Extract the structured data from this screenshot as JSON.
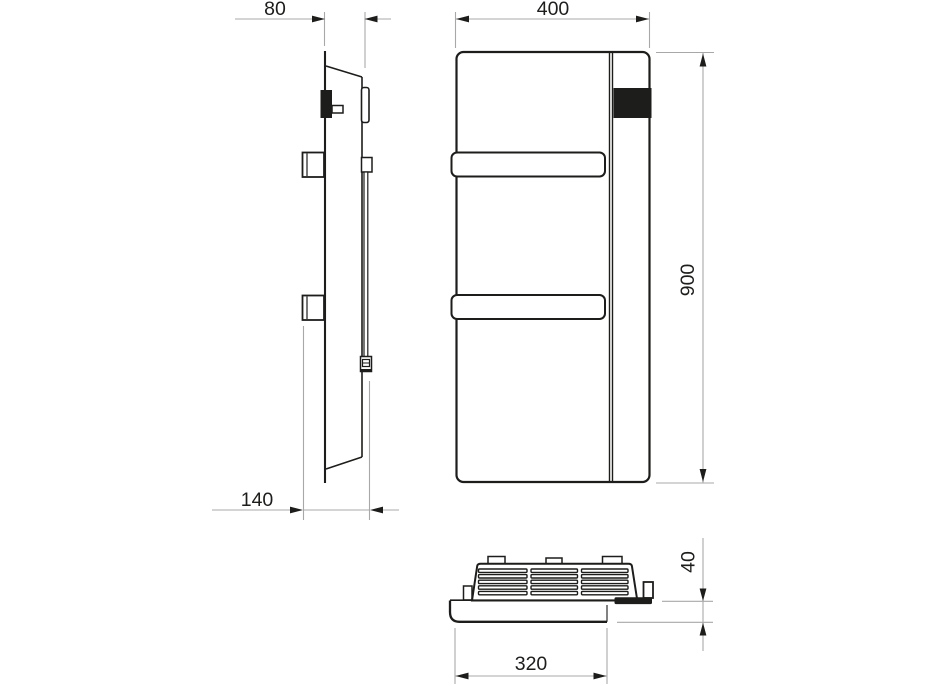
{
  "drawing": {
    "type": "technical-dimension-drawing",
    "subject": "towel-radiator",
    "views": [
      "side-view",
      "front-view",
      "bottom-view"
    ]
  },
  "dimensions": {
    "depth": {
      "label": "80"
    },
    "width": {
      "label": "400"
    },
    "height": {
      "label": "900"
    },
    "wall_distance": {
      "label": "140"
    },
    "body_width": {
      "label": "320"
    },
    "panel_depth": {
      "label": "40"
    }
  },
  "colors": {
    "outline": "#1d1d1b",
    "dimension_line": "#a8a8a8",
    "text": "#1d1d1b",
    "background": "#ffffff"
  }
}
